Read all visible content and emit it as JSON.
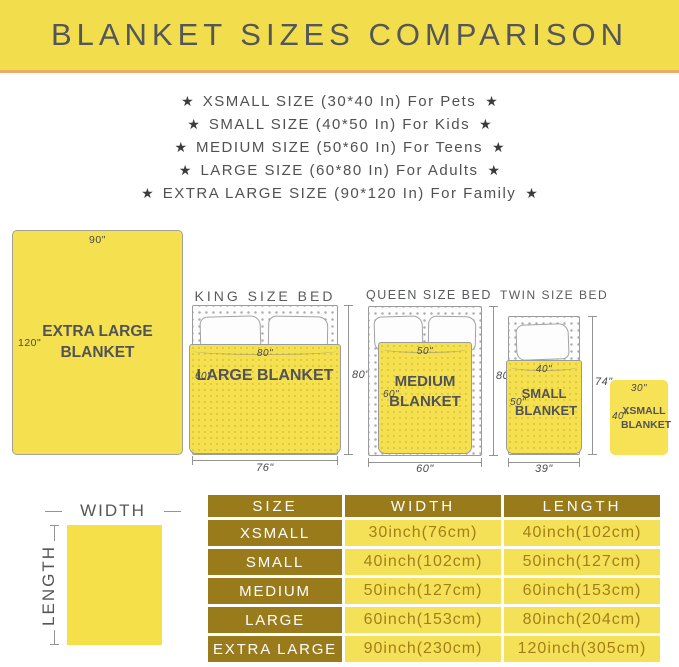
{
  "banner": {
    "title": "BLANKET SIZES COMPARISON"
  },
  "size_list": {
    "star_glyph": "★",
    "items": [
      "XSMALL SIZE (30*40 In) For Pets",
      "SMALL SIZE (40*50 In) For Kids",
      "MEDIUM SIZE (50*60 In) For Teens",
      "LARGE SIZE (60*80 In) For Adults",
      "EXTRA LARGE SIZE (90*120 In) For Family"
    ]
  },
  "diagrams": {
    "xl_blanket": {
      "name": "EXTRA LARGE BLANKET",
      "width": "90\"",
      "length": "120\""
    },
    "king": {
      "bed_title": "KING SIZE BED",
      "blanket_name": "LARGE BLANKET",
      "blanket_width": "80\"",
      "blanket_length": "60\"",
      "bed_length": "80\"",
      "bed_width": "76\""
    },
    "queen": {
      "bed_title": "QUEEN SIZE BED",
      "blanket_name": "MEDIUM BLANKET",
      "blanket_width": "50\"",
      "blanket_length": "60\"",
      "bed_length": "80\"",
      "bed_width": "60\""
    },
    "twin": {
      "bed_title": "TWIN SIZE BED",
      "blanket_name": "SMALL BLANKET",
      "blanket_width": "40\"",
      "blanket_length": "50\"",
      "bed_length": "74\"",
      "bed_width": "39\""
    },
    "xs_blanket": {
      "name": "XSMALL BLANKET",
      "width": "30\"",
      "length": "40\""
    },
    "axes_legend": {
      "width": "WIDTH",
      "length": "LENGTH"
    }
  },
  "table": {
    "headers": {
      "size": "SIZE",
      "width": "WIDTH",
      "length": "LENGTH"
    },
    "rows": [
      {
        "size": "XSMALL",
        "width": "30inch(76cm)",
        "length": "40inch(102cm)"
      },
      {
        "size": "SMALL",
        "width": "40inch(102cm)",
        "length": "50inch(127cm)"
      },
      {
        "size": "MEDIUM",
        "width": "50inch(127cm)",
        "length": "60inch(153cm)"
      },
      {
        "size": "LARGE",
        "width": "60inch(153cm)",
        "length": "80inch(204cm)"
      },
      {
        "size": "EXTRA LARGE",
        "width": "90inch(230cm)",
        "length": "120inch(305cm)"
      }
    ]
  },
  "colors": {
    "banner_yellow": "#F2DE4C",
    "accent_orange": "#EDAB67",
    "blanket_yellow": "#F5E14F",
    "blanket_dot": "#E2C73C",
    "table_gold": "#9A7B1B",
    "table_cell_yellow": "#F5E158",
    "table_cell_text": "#A27F19",
    "text_gray": "#58585A"
  }
}
